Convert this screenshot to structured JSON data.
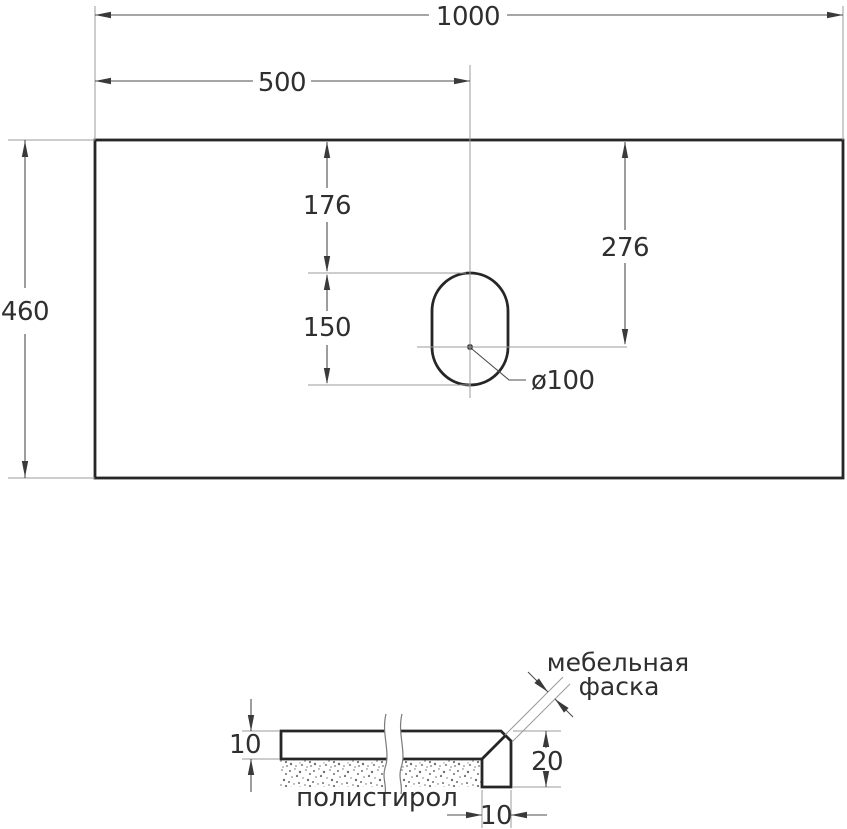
{
  "top_view": {
    "total_width": "1000",
    "half_width": "500",
    "depth": "460",
    "cutout_top_offset": "176",
    "cutout_arc_center_offset": "276",
    "cutout_length": "150",
    "cutout_diameter": "ø100"
  },
  "section_view": {
    "slab_thickness": "10",
    "edge_height": "20",
    "edge_width": "10",
    "core_material_label": "полистирол",
    "chamfer_label_line1": "мебельная",
    "chamfer_label_line2": "фаска"
  },
  "colors": {
    "background": "#ffffff",
    "outline": "#262626",
    "thin_line": "#9b9b9b",
    "dimension_line": "#4d4d4d",
    "text": "#2f2f2f",
    "hatch": "#5a5a5a",
    "stipple": "#6f6f6f"
  }
}
